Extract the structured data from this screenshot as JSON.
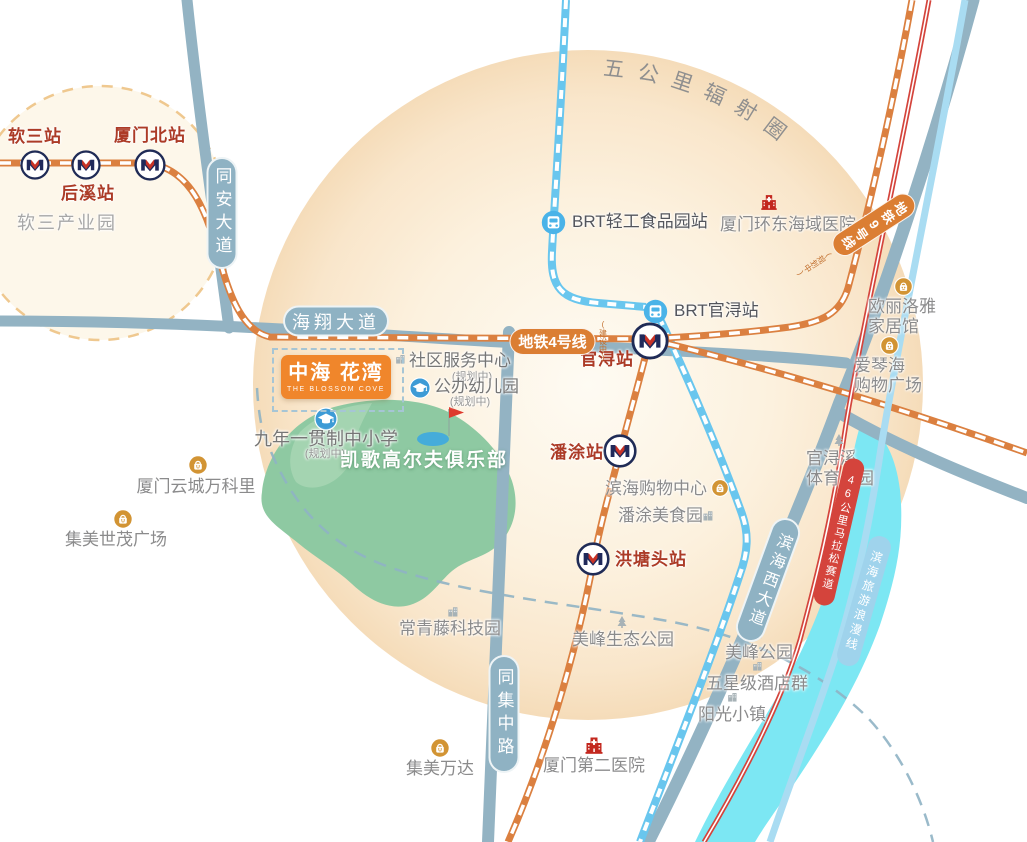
{
  "zone": {
    "radius_circle_label": "五公里辐射圈"
  },
  "project": {
    "name": "中海 花湾",
    "name_en": "THE BLOSSOM COVE"
  },
  "badges": [
    {
      "id": "road-tongan-avenue",
      "text": "同安大道",
      "type": "road",
      "orient": "v",
      "x": 222,
      "y": 213,
      "w": 31,
      "h": 112,
      "fs": 17,
      "ls": 6
    },
    {
      "id": "road-haixiang-avenue",
      "text": "海翔大道",
      "type": "road",
      "orient": "h",
      "x": 336,
      "y": 321,
      "w": 106,
      "h": 31,
      "fs": 18,
      "ls": 4
    },
    {
      "id": "road-tongji-middle",
      "text": "同集中路",
      "type": "road",
      "orient": "v",
      "x": 504,
      "y": 714,
      "w": 31,
      "h": 118,
      "fs": 17,
      "ls": 6
    },
    {
      "id": "road-binhai-west-avenue",
      "text": "滨海西大道",
      "type": "road",
      "orient": "v",
      "x": 768,
      "y": 580,
      "w": 30,
      "h": 130,
      "fs": 16,
      "ls": 4,
      "rot": 20
    },
    {
      "id": "line-metro-4",
      "text": "地铁4号线",
      "type": "metro",
      "orient": "h",
      "x": 558,
      "y": 341,
      "w": 86,
      "h": 27,
      "fs": 15,
      "ls": 0,
      "note": {
        "text": "(建设中)"
      }
    },
    {
      "id": "line-metro-9",
      "text": "地铁9号线",
      "type": "metro",
      "orient": "v",
      "x": 855,
      "y": 237,
      "w": 25,
      "h": 94,
      "fs": 13,
      "ls": 2,
      "rot": 57,
      "note": {
        "text": "(规划中)"
      }
    },
    {
      "id": "line-marathon-track",
      "text": "46公里马拉松赛道",
      "type": "marathon",
      "orient": "v",
      "x": 839,
      "y": 532,
      "w": 21,
      "h": 150,
      "fs": 11,
      "ls": 2,
      "rot": 13
    },
    {
      "id": "line-romantic-coast",
      "text": "滨海旅游浪漫线",
      "type": "romantic",
      "orient": "v",
      "x": 864,
      "y": 601,
      "w": 23,
      "h": 134,
      "fs": 12,
      "ls": 3,
      "rot": 16
    }
  ],
  "stations": [
    {
      "id": "station-ruansan",
      "name": "软三站",
      "x": 35,
      "y": 165,
      "s": 30,
      "lx": 35,
      "ly": 127,
      "anchor": "c"
    },
    {
      "id": "station-houxi",
      "name": "后溪站",
      "x": 86,
      "y": 165,
      "s": 30,
      "lx": 88,
      "ly": 184,
      "anchor": "c"
    },
    {
      "id": "station-xiamen-north",
      "name": "厦门北站",
      "x": 150,
      "y": 165,
      "s": 32,
      "lx": 150,
      "ly": 126,
      "anchor": "c"
    },
    {
      "id": "station-guanxun",
      "name": "官浔站",
      "x": 650,
      "y": 341,
      "s": 38,
      "lx": 607,
      "ly": 350,
      "anchor": "c"
    },
    {
      "id": "station-pantu",
      "name": "潘涂站",
      "x": 620,
      "y": 451,
      "s": 34,
      "lx": 577,
      "ly": 443,
      "anchor": "c"
    },
    {
      "id": "station-hongtangtou",
      "name": "洪塘头站",
      "x": 593,
      "y": 559,
      "s": 34,
      "lx": 615,
      "ly": 550,
      "anchor": "l"
    }
  ],
  "brt_stations": [
    {
      "id": "brt-station-qinggong-food-park",
      "name": "BRT轻工食品园站",
      "x": 553,
      "y": 222,
      "s": 27,
      "lx": 572,
      "ly": 212,
      "anchor": "l"
    },
    {
      "id": "brt-station-guanxun",
      "name": "BRT官浔站",
      "x": 655,
      "y": 311,
      "s": 27,
      "lx": 674,
      "ly": 301,
      "anchor": "l"
    }
  ],
  "pois": [
    {
      "id": "poi-ruansan-industrial-park",
      "text": "软三产业园",
      "lx": 67,
      "ly": 213,
      "anchor": "c",
      "cls": "poi-light"
    },
    {
      "id": "poi-yuncheng-vankeli",
      "text": "厦门云城万科里",
      "lx": 196,
      "ly": 477,
      "anchor": "c",
      "icon": {
        "type": "bag",
        "x": 198,
        "y": 465,
        "s": 20
      }
    },
    {
      "id": "poi-jimei-shimao-plaza",
      "text": "集美世茂广场",
      "lx": 116,
      "ly": 530,
      "anchor": "c",
      "icon": {
        "type": "bag",
        "x": 123,
        "y": 519,
        "s": 20
      }
    },
    {
      "id": "poi-changqingteng-tech-park",
      "text": "常青藤科技园",
      "lx": 450,
      "ly": 619,
      "anchor": "c",
      "icon": {
        "type": "building",
        "x": 452,
        "y": 610,
        "s": 13
      }
    },
    {
      "id": "poi-meifeng-eco-park",
      "text": "美峰生态公园",
      "lx": 623,
      "ly": 630,
      "anchor": "c",
      "icon": {
        "type": "tree",
        "x": 622,
        "y": 621,
        "s": 14
      }
    },
    {
      "id": "poi-jimei-wanda",
      "text": "集美万达",
      "lx": 440,
      "ly": 759,
      "anchor": "c",
      "icon": {
        "type": "bag",
        "x": 440,
        "y": 748,
        "s": 20
      }
    },
    {
      "id": "poi-xiamen-second-hospital",
      "text": "厦门第二医院",
      "lx": 594,
      "ly": 756,
      "anchor": "c",
      "icon": {
        "type": "hospital",
        "x": 594,
        "y": 744,
        "s": 22
      }
    },
    {
      "id": "poi-binhai-shopping-center",
      "text": "滨海购物中心",
      "lx": 605,
      "ly": 479,
      "anchor": "l",
      "icon": {
        "type": "bag",
        "x": 720,
        "y": 488,
        "s": 18
      }
    },
    {
      "id": "poi-pantu-food-park",
      "text": "潘涂美食园",
      "lx": 618,
      "ly": 506,
      "anchor": "l",
      "icon": {
        "type": "building",
        "x": 707,
        "y": 514,
        "s": 13
      }
    },
    {
      "id": "poi-guanxunxi-sports-park",
      "text": "官浔溪\n体育公园",
      "lx": 840,
      "ly": 449,
      "anchor": "c",
      "icon": {
        "type": "tree",
        "x": 839,
        "y": 439,
        "s": 14
      }
    },
    {
      "id": "poi-huandong-hospital",
      "text": "厦门环东海域医院",
      "lx": 788,
      "ly": 215,
      "anchor": "c",
      "icon": {
        "type": "hospital",
        "x": 769,
        "y": 201,
        "s": 20
      }
    },
    {
      "id": "poi-oulilouya-home-mall",
      "text": "欧丽洛雅\n家居馆",
      "lx": 902,
      "ly": 297,
      "anchor": "c",
      "icon": {
        "type": "bag",
        "x": 903,
        "y": 286,
        "s": 19
      }
    },
    {
      "id": "poi-aiqinhai-shopping-plaza",
      "text": "爱琴海\n购物广场",
      "lx": 888,
      "ly": 356,
      "anchor": "c",
      "icon": {
        "type": "bag",
        "x": 889,
        "y": 345,
        "s": 19
      }
    },
    {
      "id": "poi-meifeng-park",
      "text": "美峰公园",
      "lx": 759,
      "ly": 643,
      "anchor": "c",
      "icon": {
        "type": "tree",
        "x": 757,
        "y": 633,
        "s": 13
      }
    },
    {
      "id": "poi-five-star-hotels",
      "text": "五星级酒店群",
      "lx": 757,
      "ly": 674,
      "anchor": "c",
      "icon": {
        "type": "building",
        "x": 757,
        "y": 665,
        "s": 12
      }
    },
    {
      "id": "poi-sunshine-town",
      "text": "阳光小镇",
      "lx": 732,
      "ly": 705,
      "anchor": "c",
      "icon": {
        "type": "building",
        "x": 732,
        "y": 696,
        "s": 12
      }
    },
    {
      "id": "poi-nine-year-school",
      "text": "九年一贯制中小学",
      "lx": 326,
      "ly": 429,
      "anchor": "c",
      "cls": "poi-dark",
      "fs": 18,
      "icon": {
        "type": "school",
        "x": 326,
        "y": 419,
        "s": 24
      },
      "note": {
        "text": "(规划中)",
        "x": 325,
        "y": 448
      }
    },
    {
      "id": "poi-community-service-center",
      "text": "社区服务中心",
      "lx": 409,
      "ly": 351,
      "anchor": "l",
      "cls": "poi-dark",
      "icon": {
        "type": "building",
        "x": 400,
        "y": 358,
        "s": 12
      },
      "note": {
        "text": "(规划中)",
        "x": 472,
        "y": 371
      }
    },
    {
      "id": "poi-public-kindergarten",
      "text": "公办幼儿园",
      "lx": 434,
      "ly": 377,
      "anchor": "l",
      "cls": "poi-dark",
      "icon": {
        "type": "school",
        "x": 420,
        "y": 388,
        "s": 22
      },
      "note": {
        "text": "(规划中)",
        "x": 470,
        "y": 396
      }
    },
    {
      "id": "poi-kaige-golf-club",
      "text": "凯歌高尔夫俱乐部",
      "lx": 424,
      "ly": 450,
      "anchor": "c",
      "cls": "poi-white"
    }
  ],
  "colors": {
    "metro_line": "#DB8040",
    "brt_line": "#69C6EE",
    "road": "#93B3C3",
    "accent_orange": "#F0862B",
    "station_text": "#AC3B27",
    "poi_text": "#8B8B8C",
    "marathon_red": "#D4443C",
    "river": "#7CE7F3",
    "golf_green": "#8EC9A2",
    "zone_fill": "#F9E6CB"
  }
}
